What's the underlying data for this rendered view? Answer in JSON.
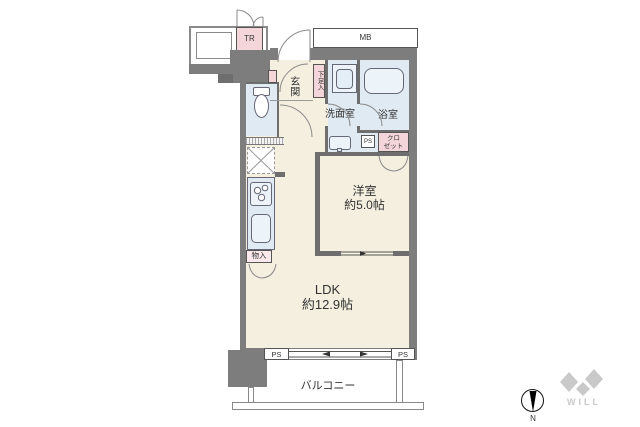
{
  "palette": {
    "wall_gray": "#7d7d7d",
    "room_cream": "#f5efe0",
    "wet_area_blue": "#dfeaf3",
    "accent_pink": "#f4d6da",
    "fixture_blue": "#ecf4fa",
    "logo_gray": "#c9c9c9"
  },
  "outside": {
    "trunk_room_label": "TR",
    "meter_box_label": "MB"
  },
  "rooms": {
    "entrance": {
      "label": "玄関"
    },
    "shoe_cabinet": {
      "label": "下足入"
    },
    "washroom": {
      "label": "洗面室"
    },
    "bathroom": {
      "label": "浴室"
    },
    "closet": {
      "line1": "クロ",
      "line2": "ゼット"
    },
    "pipe_space_upper": {
      "label": "PS"
    },
    "western_room": {
      "name": "洋室",
      "size": "約5.0帖"
    },
    "storage": {
      "label": "物入"
    },
    "ldk": {
      "name": "LDK",
      "size": "約12.9帖"
    },
    "pipe_space_left": {
      "label": "PS"
    },
    "pipe_space_right": {
      "label": "PS"
    },
    "balcony": {
      "label": "バルコニー"
    }
  },
  "compass": {
    "north_label": "N"
  },
  "brand": {
    "logo_text": "WILL"
  }
}
